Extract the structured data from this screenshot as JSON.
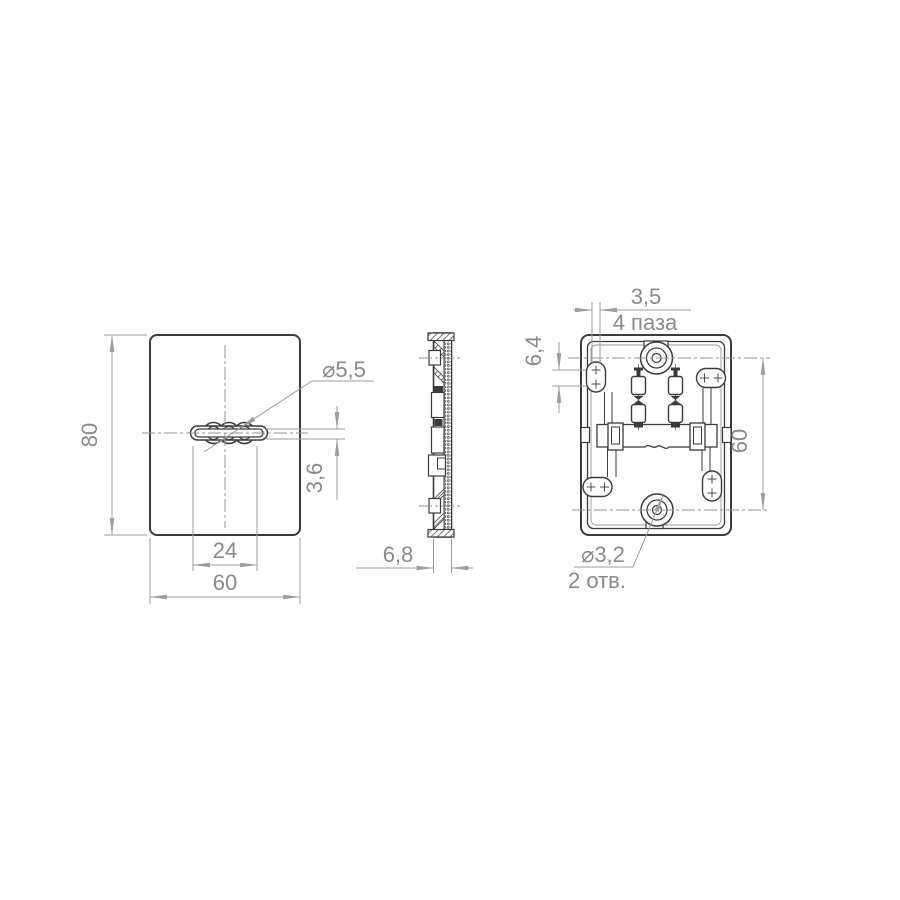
{
  "colors": {
    "background": "#ffffff",
    "part_outline": "#3b3b3b",
    "dimension_line": "#9d9d9d",
    "dimension_text": "#8a8a8a"
  },
  "views": {
    "front": {
      "height": "80",
      "width": "60",
      "slot_length": "24",
      "slot_hole_dia": "⌀5,5",
      "slot_width": "3,6"
    },
    "side": {
      "thickness": "6,8"
    },
    "back": {
      "groove_width": "3,5",
      "groove_note": "4 паза",
      "groove_height": "6,4",
      "hole_spacing": "60",
      "hole_dia": "⌀3,2",
      "hole_note": "2 отв."
    }
  }
}
